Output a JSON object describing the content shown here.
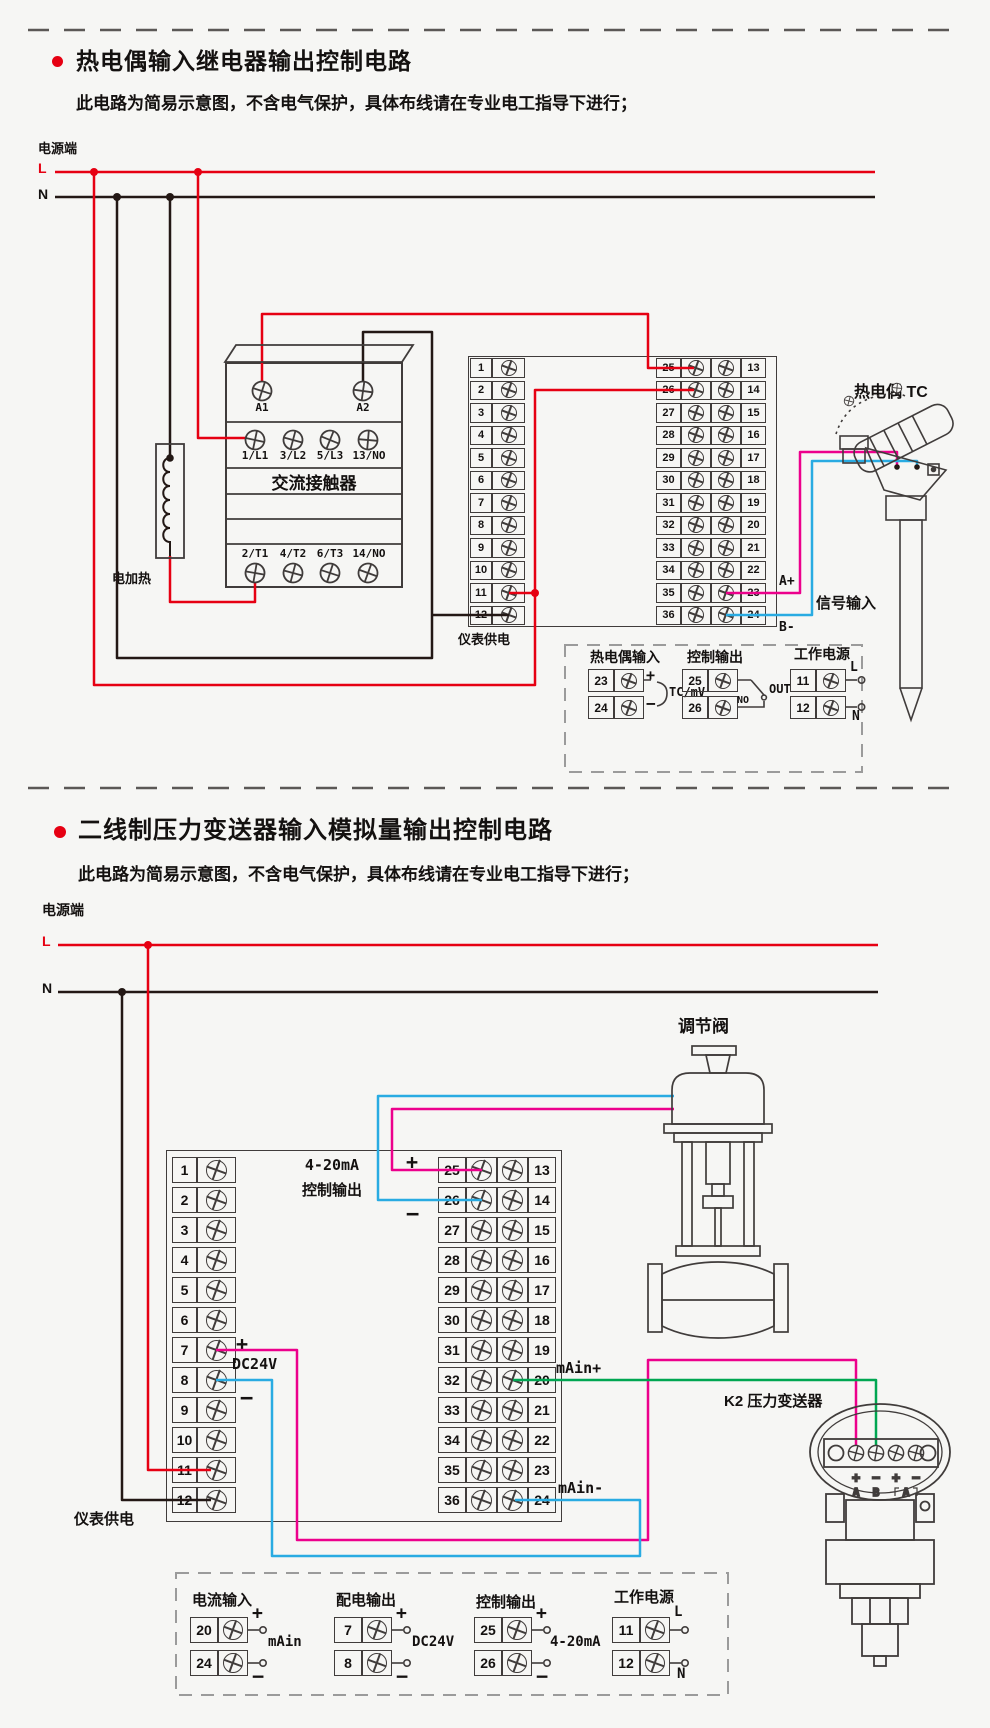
{
  "colors": {
    "live_red": "#e60012",
    "neutral_black": "#231815",
    "signal_pink": "#ec008c",
    "signal_blue": "#29abe2",
    "signal_green": "#00a651"
  },
  "s1": {
    "title": "热电偶输入继电器输出控制电路",
    "subtitle": "此电路为简易示意图，不含电气保护，具体布线请在专业电工指导下进行；",
    "power": {
      "label": "电源端",
      "l": "L",
      "n": "N"
    },
    "contactor": {
      "name": "交流接触器",
      "a1": "A1",
      "a2": "A2",
      "top_row": [
        "1/L1",
        "3/L2",
        "5/L3",
        "13/NO"
      ],
      "bottom_row": [
        "2/T1",
        "4/T2",
        "6/T3",
        "14/NO"
      ]
    },
    "heater": "电加热",
    "supply": "仪表供电",
    "terminals": {
      "left": [
        "1",
        "2",
        "3",
        "4",
        "5",
        "6",
        "7",
        "8",
        "9",
        "10",
        "11",
        "12"
      ],
      "mid": [
        "25",
        "26",
        "27",
        "28",
        "29",
        "30",
        "31",
        "32",
        "33",
        "34",
        "35",
        "36"
      ],
      "right": [
        "13",
        "14",
        "15",
        "16",
        "17",
        "18",
        "19",
        "20",
        "21",
        "22",
        "23",
        "24"
      ]
    },
    "signal": {
      "aplus": "A+",
      "bminus": "B-",
      "label": "信号输入"
    },
    "sensor": "热电偶 TC",
    "legend": {
      "c1": {
        "title": "热电偶输入",
        "r1": "23",
        "r1s": "+",
        "r2": "24",
        "r2s": "−",
        "note": "TC/mV"
      },
      "c2": {
        "title": "控制输出",
        "r1": "25",
        "r2": "26",
        "no": "NO",
        "out": "OUT"
      },
      "c3": {
        "title": "工作电源",
        "r1": "11",
        "r1s": "L",
        "r2": "12",
        "r2s": "N"
      }
    }
  },
  "s2": {
    "title": "二线制压力变送器输入模拟量输出控制电路",
    "subtitle": "此电路为简易示意图，不含电气保护，具体布线请在专业电工指导下进行；",
    "power": {
      "label": "电源端",
      "l": "L",
      "n": "N"
    },
    "valve": "调节阀",
    "transmitter": {
      "label": "K2 压力变送器",
      "signs": [
        "+",
        "−",
        "+",
        "−"
      ],
      "ch_a": "A",
      "ch_b": "B",
      "ch_a2": "A"
    },
    "instrument": {
      "out1": "4-20mA",
      "out2": "控制输出",
      "plus": "+",
      "minus": "−",
      "dc": "DC24V",
      "main_plus": "mAin+",
      "main_minus": "mAin-",
      "supply": "仪表供电"
    },
    "terminals": {
      "left": [
        "1",
        "2",
        "3",
        "4",
        "5",
        "6",
        "7",
        "8",
        "9",
        "10",
        "11",
        "12"
      ],
      "mid": [
        "25",
        "26",
        "27",
        "28",
        "29",
        "30",
        "31",
        "32",
        "33",
        "34",
        "35",
        "36"
      ],
      "right": [
        "13",
        "14",
        "15",
        "16",
        "17",
        "18",
        "19",
        "20",
        "21",
        "22",
        "23",
        "24"
      ]
    },
    "legend": {
      "c1": {
        "title": "电流输入",
        "r1": "20",
        "r1s": "+",
        "r2": "24",
        "r2s": "−",
        "note": "mAin"
      },
      "c2": {
        "title": "配电输出",
        "r1": "7",
        "r1s": "+",
        "r2": "8",
        "r2s": "−",
        "note": "DC24V"
      },
      "c3": {
        "title": "控制输出",
        "r1": "25",
        "r1s": "+",
        "r2": "26",
        "r2s": "−",
        "note": "4-20mA"
      },
      "c4": {
        "title": "工作电源",
        "r1": "11",
        "r1s": "L",
        "r2": "12",
        "r2s": "N"
      }
    }
  }
}
